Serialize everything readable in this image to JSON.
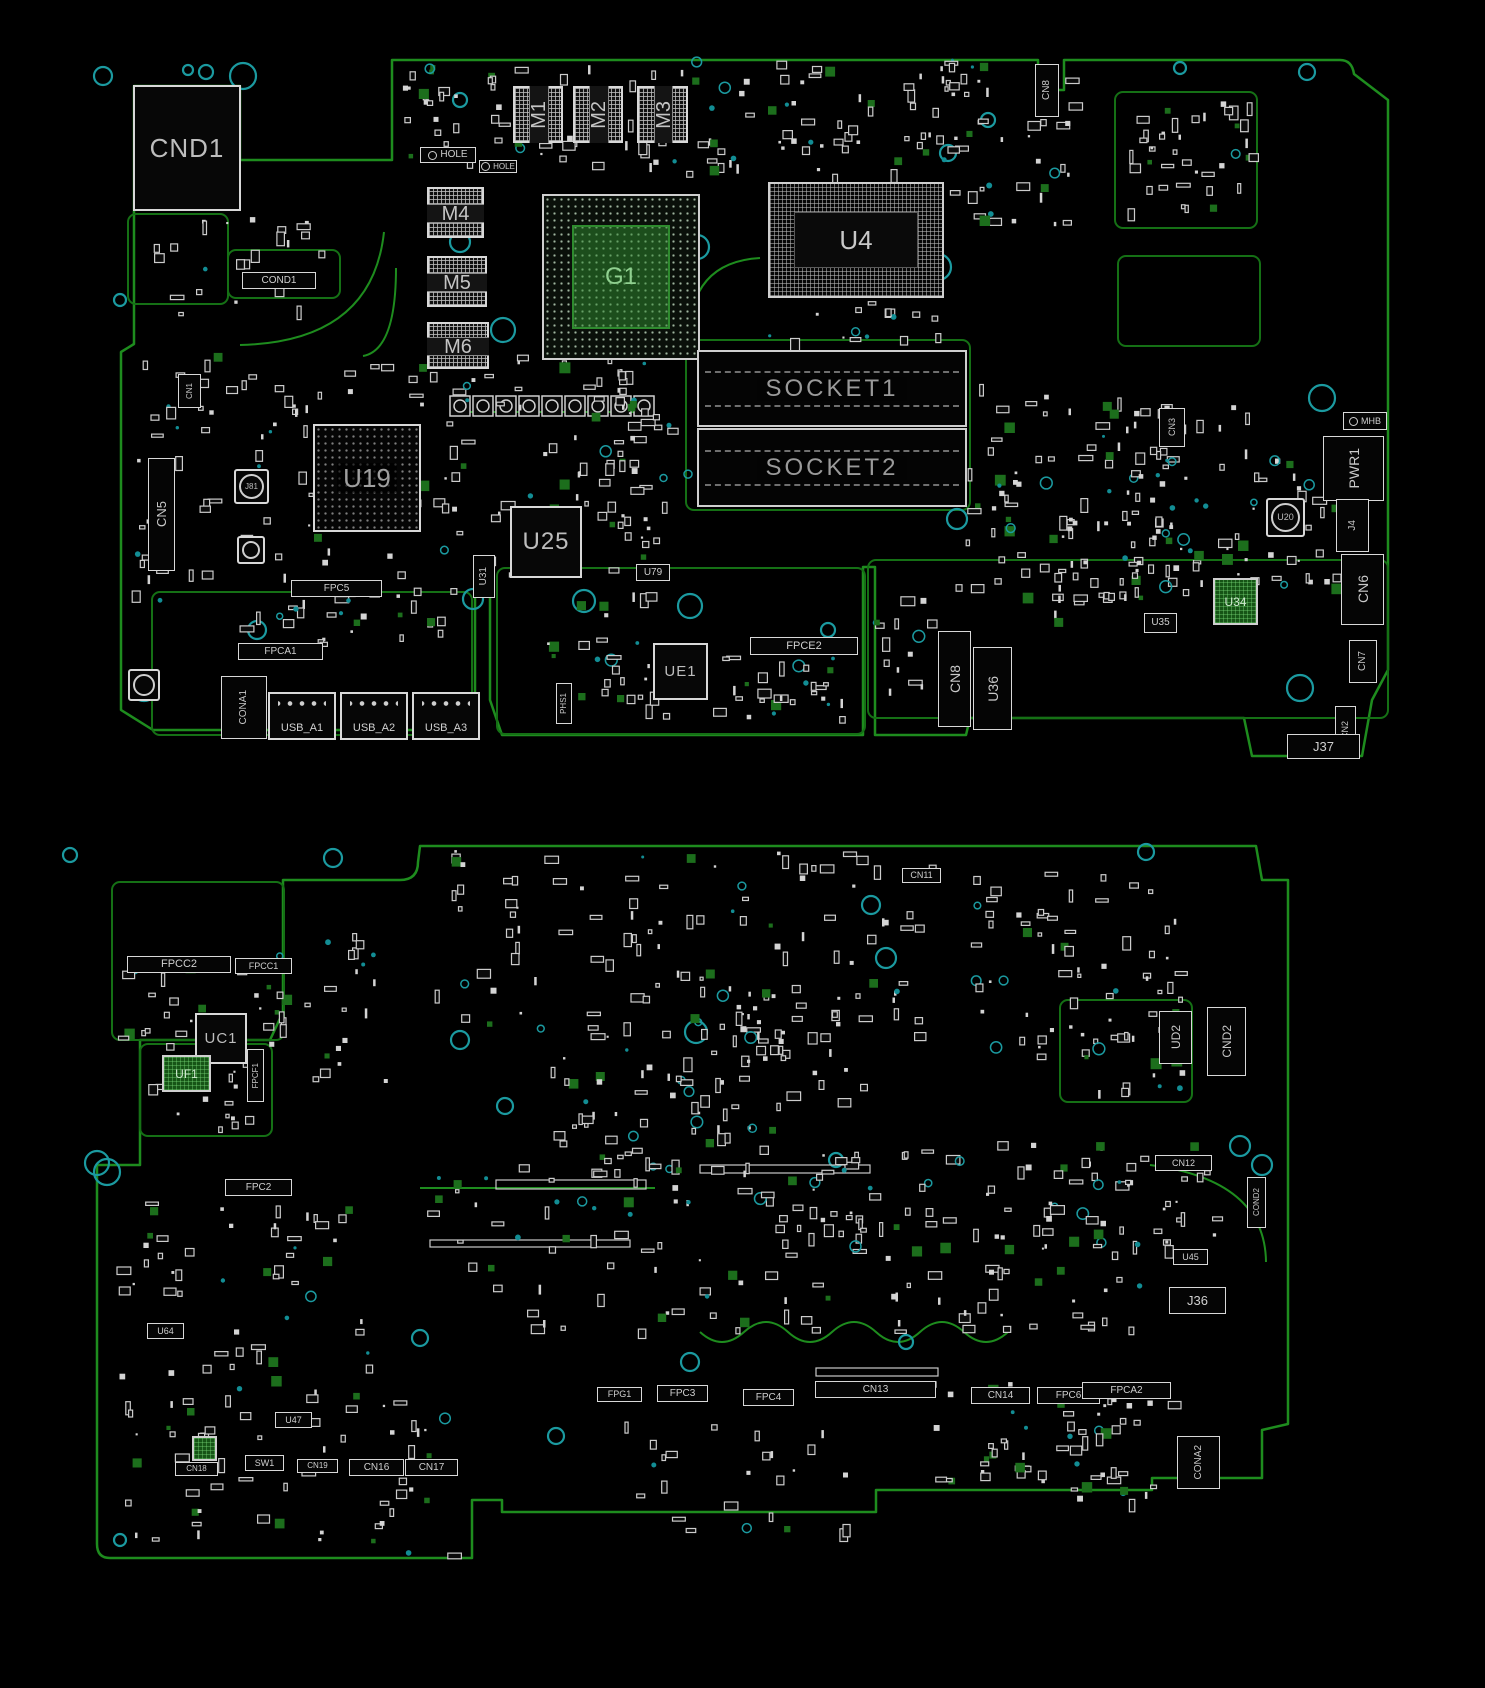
{
  "diagram": {
    "kind": "pcb-boardview",
    "palette": {
      "background": "#000000",
      "trace_green": "#1e8c1e",
      "zone_green": "#157015",
      "silkscreen_white": "#d8d8d8",
      "hole_teal": "#1b9aa0",
      "bga_green": "#2e8b2e",
      "label_gray": "#b9b9b9"
    }
  },
  "boards": [
    {
      "id": "top-view",
      "components": [
        {
          "ref": "CND1",
          "kind": "chip",
          "x": 133,
          "y": 85,
          "w": 108,
          "h": 126,
          "fs": 26
        },
        {
          "ref": "COND1",
          "kind": "labelbox",
          "x": 242,
          "y": 272,
          "w": 74,
          "h": 17,
          "fs": 10
        },
        {
          "ref": "HOLE",
          "kind": "hole-label",
          "x": 420,
          "y": 147,
          "w": 56,
          "h": 16,
          "fs": 10
        },
        {
          "ref": "HOLE",
          "kind": "hole-label",
          "x": 479,
          "y": 160,
          "w": 38,
          "h": 13,
          "fs": 8
        },
        {
          "ref": "M1",
          "kind": "module",
          "x": 513,
          "y": 86,
          "w": 50,
          "h": 57,
          "fs": 20,
          "v": true
        },
        {
          "ref": "M2",
          "kind": "module",
          "x": 573,
          "y": 86,
          "w": 50,
          "h": 57,
          "fs": 20,
          "v": true
        },
        {
          "ref": "M3",
          "kind": "module",
          "x": 637,
          "y": 86,
          "w": 51,
          "h": 57,
          "fs": 20,
          "v": true
        },
        {
          "ref": "M4",
          "kind": "module",
          "x": 427,
          "y": 187,
          "w": 57,
          "h": 51,
          "fs": 20
        },
        {
          "ref": "M5",
          "kind": "module",
          "x": 427,
          "y": 256,
          "w": 60,
          "h": 51,
          "fs": 20
        },
        {
          "ref": "M6",
          "kind": "module",
          "x": 427,
          "y": 322,
          "w": 62,
          "h": 47,
          "fs": 20
        },
        {
          "ref": "G1",
          "kind": "bga-green",
          "x": 542,
          "y": 194,
          "w": 158,
          "h": 166,
          "fs": 24
        },
        {
          "ref": "U4",
          "kind": "bga-grid",
          "x": 768,
          "y": 182,
          "w": 176,
          "h": 116,
          "fs": 26
        },
        {
          "ref": "SOCKET1",
          "kind": "socket",
          "x": 697,
          "y": 350,
          "w": 270,
          "h": 77,
          "fs": 24
        },
        {
          "ref": "SOCKET2",
          "kind": "socket",
          "x": 697,
          "y": 428,
          "w": 270,
          "h": 79,
          "fs": 24
        },
        {
          "ref": "U19",
          "kind": "bga-dark",
          "x": 313,
          "y": 424,
          "w": 108,
          "h": 108,
          "fs": 26
        },
        {
          "ref": "CN1",
          "kind": "conn-v",
          "x": 178,
          "y": 374,
          "w": 23,
          "h": 34,
          "fs": 8
        },
        {
          "ref": "J81",
          "kind": "circle-comp",
          "x": 234,
          "y": 469,
          "w": 35,
          "h": 35,
          "fs": 8
        },
        {
          "ref": "",
          "kind": "circle-comp",
          "x": 237,
          "y": 536,
          "w": 28,
          "h": 28,
          "fs": 0
        },
        {
          "ref": "CN5",
          "kind": "conn-v",
          "x": 148,
          "y": 458,
          "w": 27,
          "h": 113,
          "fs": 13
        },
        {
          "ref": "FPC5",
          "kind": "labelbox",
          "x": 291,
          "y": 580,
          "w": 91,
          "h": 17,
          "fs": 10
        },
        {
          "ref": "U25",
          "kind": "chip",
          "x": 510,
          "y": 506,
          "w": 72,
          "h": 72,
          "fs": 24
        },
        {
          "ref": "U31",
          "kind": "conn-v",
          "x": 473,
          "y": 555,
          "w": 22,
          "h": 43,
          "fs": 10
        },
        {
          "ref": "U79",
          "kind": "labelbox",
          "x": 636,
          "y": 564,
          "w": 34,
          "h": 17,
          "fs": 10
        },
        {
          "ref": "UE1",
          "kind": "chip",
          "x": 653,
          "y": 643,
          "w": 55,
          "h": 57,
          "fs": 15
        },
        {
          "ref": "FPCE2",
          "kind": "labelbox",
          "x": 750,
          "y": 637,
          "w": 108,
          "h": 18,
          "fs": 11
        },
        {
          "ref": "PHS1",
          "kind": "conn-v",
          "x": 556,
          "y": 683,
          "w": 16,
          "h": 41,
          "fs": 8
        },
        {
          "ref": "CN8",
          "kind": "conn-v",
          "x": 938,
          "y": 631,
          "w": 33,
          "h": 96,
          "fs": 14
        },
        {
          "ref": "U36",
          "kind": "conn-v",
          "x": 973,
          "y": 647,
          "w": 39,
          "h": 83,
          "fs": 14
        },
        {
          "ref": "CN8",
          "kind": "conn-v",
          "x": 1035,
          "y": 64,
          "w": 24,
          "h": 53,
          "fs": 10
        },
        {
          "ref": "U35",
          "kind": "labelbox",
          "x": 1144,
          "y": 613,
          "w": 33,
          "h": 20,
          "fs": 10
        },
        {
          "ref": "U34",
          "kind": "chip-green",
          "x": 1213,
          "y": 578,
          "w": 45,
          "h": 47,
          "fs": 12
        },
        {
          "ref": "U20",
          "kind": "circle-comp",
          "x": 1266,
          "y": 498,
          "w": 39,
          "h": 39,
          "fs": 9
        },
        {
          "ref": "CN3",
          "kind": "conn-v",
          "x": 1159,
          "y": 408,
          "w": 26,
          "h": 39,
          "fs": 9
        },
        {
          "ref": "MHB",
          "kind": "hole-label",
          "x": 1343,
          "y": 412,
          "w": 44,
          "h": 18,
          "fs": 9
        },
        {
          "ref": "PWR1",
          "kind": "conn-v",
          "x": 1323,
          "y": 436,
          "w": 61,
          "h": 65,
          "fs": 14
        },
        {
          "ref": "J4",
          "kind": "conn-v",
          "x": 1336,
          "y": 499,
          "w": 33,
          "h": 53,
          "fs": 10
        },
        {
          "ref": "CN6",
          "kind": "conn-v",
          "x": 1341,
          "y": 554,
          "w": 43,
          "h": 71,
          "fs": 14
        },
        {
          "ref": "CN7",
          "kind": "conn-v",
          "x": 1349,
          "y": 640,
          "w": 28,
          "h": 43,
          "fs": 10
        },
        {
          "ref": "CN2",
          "kind": "conn-v",
          "x": 1335,
          "y": 706,
          "w": 21,
          "h": 49,
          "fs": 9
        },
        {
          "ref": "J37",
          "kind": "labelbox",
          "x": 1287,
          "y": 734,
          "w": 73,
          "h": 25,
          "fs": 13
        },
        {
          "ref": "FPCA1",
          "kind": "labelbox",
          "x": 238,
          "y": 643,
          "w": 85,
          "h": 17,
          "fs": 10
        },
        {
          "ref": "CONA1",
          "kind": "conn-v",
          "x": 221,
          "y": 676,
          "w": 46,
          "h": 63,
          "fs": 10
        },
        {
          "ref": "",
          "kind": "circle-comp",
          "x": 128,
          "y": 669,
          "w": 32,
          "h": 32,
          "fs": 0
        },
        {
          "ref": "USB_A1",
          "kind": "usb",
          "x": 268,
          "y": 692,
          "w": 68,
          "h": 48,
          "fs": 11
        },
        {
          "ref": "USB_A2",
          "kind": "usb",
          "x": 340,
          "y": 692,
          "w": 68,
          "h": 48,
          "fs": 11
        },
        {
          "ref": "USB_A3",
          "kind": "usb",
          "x": 412,
          "y": 692,
          "w": 68,
          "h": 48,
          "fs": 11
        }
      ]
    },
    {
      "id": "bottom-view",
      "components": [
        {
          "ref": "FPCC2",
          "kind": "labelbox",
          "x": 127,
          "y": 956,
          "w": 104,
          "h": 17,
          "fs": 11
        },
        {
          "ref": "FPCC1",
          "kind": "labelbox",
          "x": 235,
          "y": 958,
          "w": 57,
          "h": 16,
          "fs": 9
        },
        {
          "ref": "UC1",
          "kind": "chip",
          "x": 195,
          "y": 1013,
          "w": 52,
          "h": 51,
          "fs": 15
        },
        {
          "ref": "CN11",
          "kind": "labelbox",
          "x": 902,
          "y": 868,
          "w": 39,
          "h": 15,
          "fs": 9
        },
        {
          "ref": "UF1",
          "kind": "chip-green",
          "x": 162,
          "y": 1055,
          "w": 49,
          "h": 37,
          "fs": 12
        },
        {
          "ref": "FPCF1",
          "kind": "conn-v",
          "x": 247,
          "y": 1049,
          "w": 17,
          "h": 53,
          "fs": 8
        },
        {
          "ref": "FPC2",
          "kind": "labelbox",
          "x": 225,
          "y": 1179,
          "w": 67,
          "h": 17,
          "fs": 10
        },
        {
          "ref": "UD2",
          "kind": "conn-v",
          "x": 1159,
          "y": 1011,
          "w": 33,
          "h": 53,
          "fs": 12
        },
        {
          "ref": "CND2",
          "kind": "conn-v",
          "x": 1207,
          "y": 1007,
          "w": 39,
          "h": 69,
          "fs": 12
        },
        {
          "ref": "CN12",
          "kind": "labelbox",
          "x": 1155,
          "y": 1155,
          "w": 57,
          "h": 16,
          "fs": 9
        },
        {
          "ref": "COND2",
          "kind": "conn-v",
          "x": 1247,
          "y": 1177,
          "w": 19,
          "h": 51,
          "fs": 8
        },
        {
          "ref": "U45",
          "kind": "labelbox",
          "x": 1173,
          "y": 1249,
          "w": 35,
          "h": 16,
          "fs": 9
        },
        {
          "ref": "J36",
          "kind": "labelbox",
          "x": 1169,
          "y": 1287,
          "w": 57,
          "h": 27,
          "fs": 13
        },
        {
          "ref": "FPG1",
          "kind": "labelbox",
          "x": 597,
          "y": 1387,
          "w": 45,
          "h": 15,
          "fs": 9
        },
        {
          "ref": "FPC3",
          "kind": "labelbox",
          "x": 657,
          "y": 1385,
          "w": 51,
          "h": 17,
          "fs": 10
        },
        {
          "ref": "FPC4",
          "kind": "labelbox",
          "x": 743,
          "y": 1389,
          "w": 51,
          "h": 17,
          "fs": 10
        },
        {
          "ref": "CN13",
          "kind": "labelbox",
          "x": 815,
          "y": 1381,
          "w": 121,
          "h": 17,
          "fs": 10
        },
        {
          "ref": "CN14",
          "kind": "labelbox",
          "x": 971,
          "y": 1387,
          "w": 59,
          "h": 17,
          "fs": 10
        },
        {
          "ref": "FPC6",
          "kind": "labelbox",
          "x": 1037,
          "y": 1387,
          "w": 63,
          "h": 17,
          "fs": 10
        },
        {
          "ref": "U64",
          "kind": "labelbox",
          "x": 147,
          "y": 1323,
          "w": 37,
          "h": 16,
          "fs": 9
        },
        {
          "ref": "U47",
          "kind": "labelbox",
          "x": 275,
          "y": 1412,
          "w": 37,
          "h": 16,
          "fs": 9
        },
        {
          "ref": "SW1",
          "kind": "labelbox",
          "x": 245,
          "y": 1455,
          "w": 39,
          "h": 16,
          "fs": 9
        },
        {
          "ref": "CN18",
          "kind": "labelbox",
          "x": 175,
          "y": 1462,
          "w": 43,
          "h": 14,
          "fs": 8
        },
        {
          "ref": "CN19",
          "kind": "labelbox",
          "x": 297,
          "y": 1459,
          "w": 41,
          "h": 14,
          "fs": 8
        },
        {
          "ref": "CN16",
          "kind": "labelbox",
          "x": 349,
          "y": 1459,
          "w": 55,
          "h": 17,
          "fs": 10
        },
        {
          "ref": "CN17",
          "kind": "labelbox",
          "x": 405,
          "y": 1459,
          "w": 53,
          "h": 17,
          "fs": 10
        },
        {
          "ref": "FPCA2",
          "kind": "labelbox",
          "x": 1082,
          "y": 1382,
          "w": 89,
          "h": 17,
          "fs": 10
        },
        {
          "ref": "CONA2",
          "kind": "conn-v",
          "x": 1177,
          "y": 1436,
          "w": 43,
          "h": 53,
          "fs": 10
        },
        {
          "ref": "",
          "kind": "chip-green",
          "x": 192,
          "y": 1436,
          "w": 25,
          "h": 25,
          "fs": 0
        }
      ]
    }
  ]
}
